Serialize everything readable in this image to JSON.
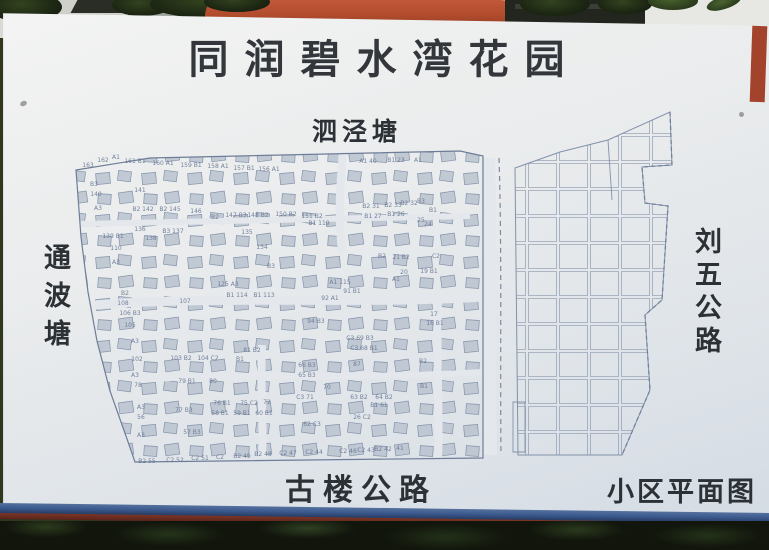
{
  "sign": {
    "title": "同润碧水湾花园",
    "caption": "小区平面图"
  },
  "map": {
    "labels": {
      "north": "泗泾塘",
      "west": "通波塘",
      "east": "刘五公路",
      "south": "古楼公路"
    },
    "plot_labels": [
      {
        "x": 88,
        "y": 167,
        "t": "163"
      },
      {
        "x": 103,
        "y": 162,
        "t": "162"
      },
      {
        "x": 116,
        "y": 159,
        "t": "A1"
      },
      {
        "x": 135,
        "y": 163,
        "t": "161 B1"
      },
      {
        "x": 163,
        "y": 165,
        "t": "160 A1"
      },
      {
        "x": 191,
        "y": 167,
        "t": "159 B1"
      },
      {
        "x": 218,
        "y": 168,
        "t": "158 A1"
      },
      {
        "x": 244,
        "y": 170,
        "t": "157 B1"
      },
      {
        "x": 269,
        "y": 171,
        "t": "156 A1"
      },
      {
        "x": 368,
        "y": 163,
        "t": "A1 40"
      },
      {
        "x": 396,
        "y": 162,
        "t": "B1 23"
      },
      {
        "x": 418,
        "y": 162,
        "t": "A1"
      },
      {
        "x": 94,
        "y": 186,
        "t": "B3"
      },
      {
        "x": 96,
        "y": 196,
        "t": "140"
      },
      {
        "x": 140,
        "y": 192,
        "t": "141"
      },
      {
        "x": 98,
        "y": 210,
        "t": "A3"
      },
      {
        "x": 143,
        "y": 211,
        "t": "B2 142"
      },
      {
        "x": 170,
        "y": 211,
        "t": "B2 145"
      },
      {
        "x": 196,
        "y": 213,
        "t": "146"
      },
      {
        "x": 215,
        "y": 219,
        "t": "B2"
      },
      {
        "x": 236,
        "y": 217,
        "t": "147 B3"
      },
      {
        "x": 258,
        "y": 217,
        "t": "148 B2"
      },
      {
        "x": 286,
        "y": 216,
        "t": "150 B2"
      },
      {
        "x": 312,
        "y": 218,
        "t": "151 B2"
      },
      {
        "x": 319,
        "y": 225,
        "t": "B1 119"
      },
      {
        "x": 371,
        "y": 208,
        "t": "B2 31"
      },
      {
        "x": 393,
        "y": 207,
        "t": "B2 33"
      },
      {
        "x": 409,
        "y": 205,
        "t": "B2 32"
      },
      {
        "x": 421,
        "y": 203,
        "t": "B3"
      },
      {
        "x": 433,
        "y": 212,
        "t": "B1"
      },
      {
        "x": 373,
        "y": 218,
        "t": "B1 27"
      },
      {
        "x": 396,
        "y": 216,
        "t": "B1 26"
      },
      {
        "x": 421,
        "y": 222,
        "t": "25"
      },
      {
        "x": 428,
        "y": 226,
        "t": "24"
      },
      {
        "x": 113,
        "y": 238,
        "t": "139 B1"
      },
      {
        "x": 140,
        "y": 231,
        "t": "136"
      },
      {
        "x": 151,
        "y": 240,
        "t": "138"
      },
      {
        "x": 173,
        "y": 233,
        "t": "B3 137"
      },
      {
        "x": 247,
        "y": 234,
        "t": "135"
      },
      {
        "x": 262,
        "y": 249,
        "t": "134"
      },
      {
        "x": 116,
        "y": 250,
        "t": "110"
      },
      {
        "x": 116,
        "y": 264,
        "t": "A3"
      },
      {
        "x": 271,
        "y": 268,
        "t": "B3"
      },
      {
        "x": 382,
        "y": 258,
        "t": "B2"
      },
      {
        "x": 401,
        "y": 259,
        "t": "21 B2"
      },
      {
        "x": 436,
        "y": 258,
        "t": "C2"
      },
      {
        "x": 404,
        "y": 274,
        "t": "20"
      },
      {
        "x": 429,
        "y": 273,
        "t": "19 B1"
      },
      {
        "x": 396,
        "y": 281,
        "t": "A1"
      },
      {
        "x": 228,
        "y": 286,
        "t": "125 A3"
      },
      {
        "x": 340,
        "y": 284,
        "t": "A1 115"
      },
      {
        "x": 125,
        "y": 295,
        "t": "B2"
      },
      {
        "x": 123,
        "y": 305,
        "t": "108"
      },
      {
        "x": 185,
        "y": 303,
        "t": "107"
      },
      {
        "x": 237,
        "y": 297,
        "t": "B1 114"
      },
      {
        "x": 264,
        "y": 297,
        "t": "B1 113"
      },
      {
        "x": 330,
        "y": 300,
        "t": "92 A1"
      },
      {
        "x": 352,
        "y": 293,
        "t": "91 B1"
      },
      {
        "x": 316,
        "y": 323,
        "t": "94 B3"
      },
      {
        "x": 434,
        "y": 316,
        "t": "17"
      },
      {
        "x": 435,
        "y": 325,
        "t": "16 B1"
      },
      {
        "x": 130,
        "y": 315,
        "t": "106 B3"
      },
      {
        "x": 130,
        "y": 327,
        "t": "105"
      },
      {
        "x": 135,
        "y": 343,
        "t": "A3"
      },
      {
        "x": 137,
        "y": 361,
        "t": "102"
      },
      {
        "x": 181,
        "y": 360,
        "t": "103 B2"
      },
      {
        "x": 208,
        "y": 360,
        "t": "104 C2"
      },
      {
        "x": 252,
        "y": 352,
        "t": "81 B2"
      },
      {
        "x": 240,
        "y": 361,
        "t": "B1"
      },
      {
        "x": 360,
        "y": 340,
        "t": "C3 69 B3"
      },
      {
        "x": 364,
        "y": 350,
        "t": "C3 68 B1"
      },
      {
        "x": 357,
        "y": 366,
        "t": "87"
      },
      {
        "x": 307,
        "y": 367,
        "t": "66 B3"
      },
      {
        "x": 307,
        "y": 377,
        "t": "65 B3"
      },
      {
        "x": 327,
        "y": 389,
        "t": "70"
      },
      {
        "x": 305,
        "y": 399,
        "t": "C3 71"
      },
      {
        "x": 359,
        "y": 399,
        "t": "63 B2"
      },
      {
        "x": 384,
        "y": 399,
        "t": "64 B2"
      },
      {
        "x": 379,
        "y": 407,
        "t": "B1 61"
      },
      {
        "x": 362,
        "y": 419,
        "t": "26 C2"
      },
      {
        "x": 312,
        "y": 426,
        "t": "62 C3"
      },
      {
        "x": 423,
        "y": 363,
        "t": "B2"
      },
      {
        "x": 424,
        "y": 388,
        "t": "B1"
      },
      {
        "x": 135,
        "y": 377,
        "t": "A3"
      },
      {
        "x": 138,
        "y": 387,
        "t": "78"
      },
      {
        "x": 141,
        "y": 409,
        "t": "A3"
      },
      {
        "x": 141,
        "y": 419,
        "t": "56"
      },
      {
        "x": 141,
        "y": 437,
        "t": "A3"
      },
      {
        "x": 187,
        "y": 383,
        "t": "79 B1"
      },
      {
        "x": 213,
        "y": 383,
        "t": "80"
      },
      {
        "x": 184,
        "y": 412,
        "t": "77 B3"
      },
      {
        "x": 222,
        "y": 405,
        "t": "76 B1"
      },
      {
        "x": 249,
        "y": 405,
        "t": "75 C2"
      },
      {
        "x": 267,
        "y": 404,
        "t": "72"
      },
      {
        "x": 220,
        "y": 415,
        "t": "58 B1"
      },
      {
        "x": 242,
        "y": 415,
        "t": "59 B1"
      },
      {
        "x": 264,
        "y": 415,
        "t": "60 B1"
      },
      {
        "x": 192,
        "y": 434,
        "t": "57 B3"
      },
      {
        "x": 147,
        "y": 463,
        "t": "B2 55"
      },
      {
        "x": 175,
        "y": 462,
        "t": "C2 52"
      },
      {
        "x": 200,
        "y": 460,
        "t": "C2 51"
      },
      {
        "x": 220,
        "y": 459,
        "t": "C2"
      },
      {
        "x": 242,
        "y": 458,
        "t": "B2 49"
      },
      {
        "x": 263,
        "y": 456,
        "t": "B2 48"
      },
      {
        "x": 288,
        "y": 455,
        "t": "C2 47"
      },
      {
        "x": 314,
        "y": 454,
        "t": "C2 44"
      },
      {
        "x": 348,
        "y": 453,
        "t": "C2 46"
      },
      {
        "x": 366,
        "y": 452,
        "t": "C2 43"
      },
      {
        "x": 383,
        "y": 451,
        "t": "B2 42"
      },
      {
        "x": 400,
        "y": 450,
        "t": "41"
      }
    ]
  },
  "colors": {
    "title_text": "#33373c",
    "label_text": "#2c3136",
    "board": "#e9ecee",
    "map_ink": "#7b89a2",
    "house_fill": "#b7c0cd",
    "rail_blue": "#3c5a8e",
    "rail_red": "#6c2d20",
    "wall_orange": "#b14c2c",
    "foliage": "#1c2613"
  }
}
